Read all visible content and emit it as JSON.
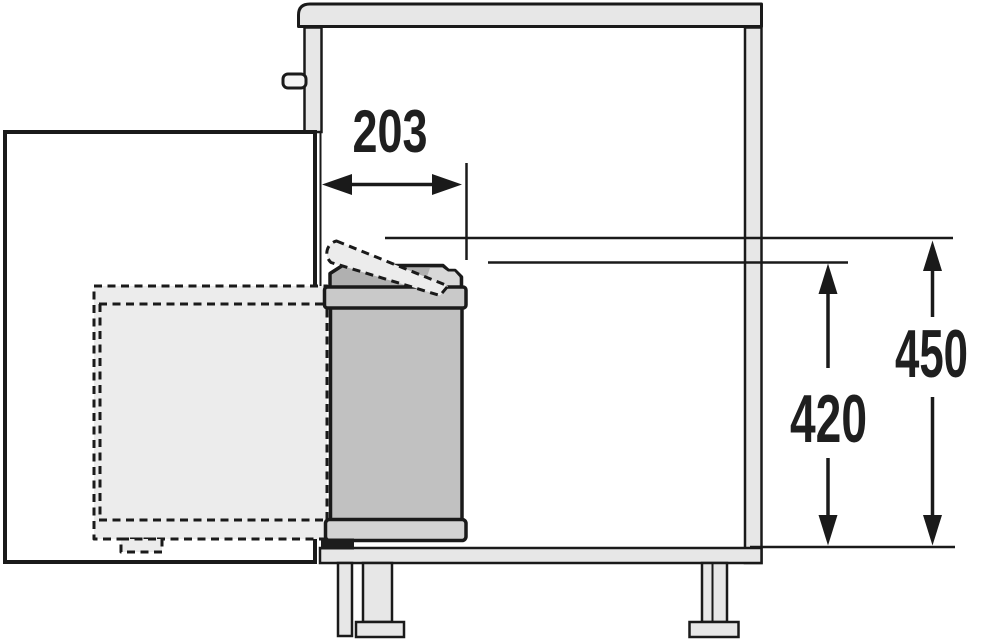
{
  "drawing": {
    "description": "Side section technical drawing of a kitchen base cabinet with a door-mounted swing-out waste bin, open door and dashed swung-out bin position",
    "dimension_labels": {
      "bin_depth_from_front": "203",
      "bin_height": "420",
      "required_clearance_height": "450"
    }
  },
  "colors": {
    "line": "#1a1a1a",
    "panel": "#e7e7e7",
    "door": "#ffffff",
    "bin_body": "#c1c1c1",
    "bin_lid": "#b0b0b0",
    "bin_lid_highlight": "#d8d8d8",
    "bin_rim": "#c9c9c9",
    "bin_base": "#d3d3d3",
    "pedal": "#1c1c1c",
    "ghost": "#ececec",
    "text": "#1f1f1f",
    "bg": "#ffffff"
  }
}
